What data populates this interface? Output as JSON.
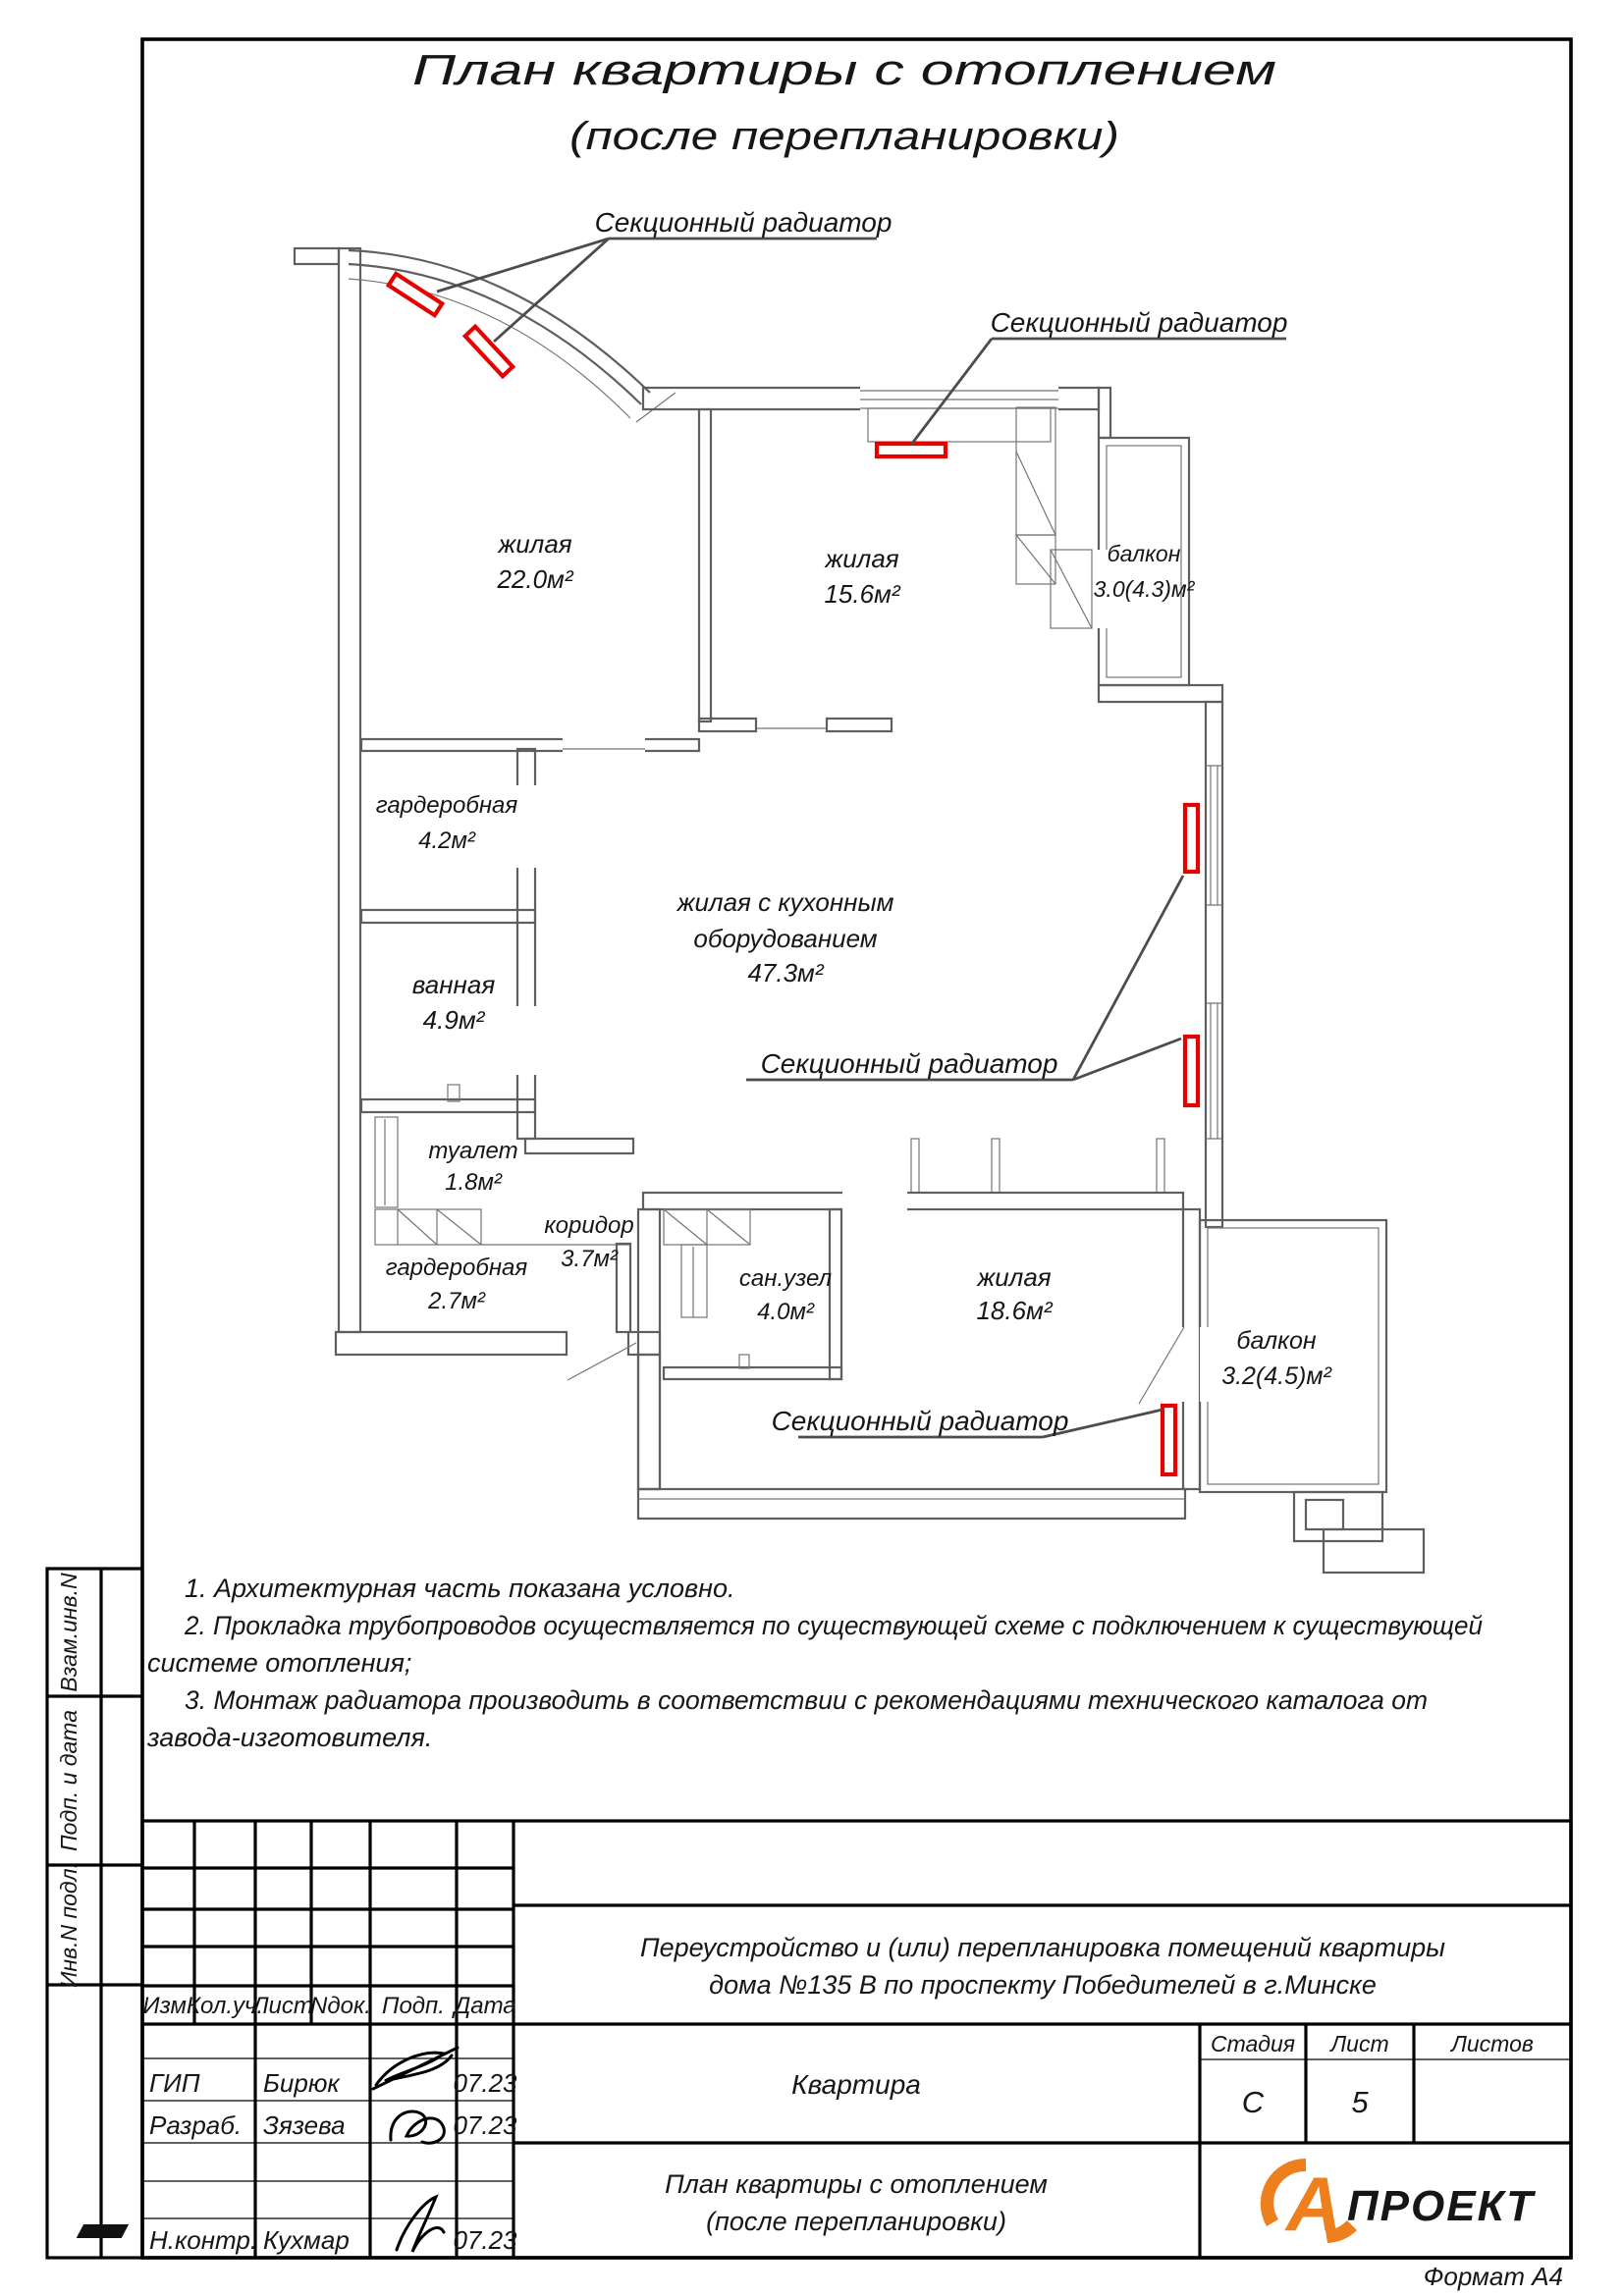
{
  "page": {
    "title_line1": "План квартиры с отоплением",
    "title_line2": "(после перепланировки)",
    "format": "Формат А4"
  },
  "colors": {
    "radiator_red": "#e60000",
    "wall_gray": "#5f5f5f",
    "logo_orange": "#ee7f1d"
  },
  "plan": {
    "radiator_label": "Секционный радиатор",
    "rooms": [
      {
        "name": "жилая",
        "area": "22.0м²"
      },
      {
        "name": "жилая",
        "area": "15.6м²"
      },
      {
        "name": "балкон",
        "area": "3.0(4.3)м²"
      },
      {
        "name": "гардеробная",
        "area": "4.2м²"
      },
      {
        "name": "ванная",
        "area": "4.9м²"
      },
      {
        "name": "туалет",
        "area": "1.8м²"
      },
      {
        "name": "коридор",
        "area": "3.7м²"
      },
      {
        "name": "гардеробная",
        "area": "2.7м²"
      },
      {
        "name": "сан.узел",
        "area": "4.0м²"
      },
      {
        "name": "жилая",
        "area": "18.6м²"
      },
      {
        "name": "балкон",
        "area": "3.2(4.5)м²"
      },
      {
        "name": "жилая с кухонным",
        "name2": "оборудованием",
        "area": "47.3м²"
      }
    ]
  },
  "notes": {
    "l1": "1. Архитектурная часть показана условно.",
    "l2": "2. Прокладка трубопроводов осуществляется по существующей схеме с подключением к существующей",
    "l3": "системе отопления;",
    "l4": "3. Монтаж радиатора производить в соответствии с рекомендациями технического каталога от",
    "l5": "завода-изготовителя."
  },
  "side_labels": {
    "vzam": "Взам.инв.N",
    "podp": "Подп. и дата",
    "inv": "Инв.N подл."
  },
  "titleblock": {
    "col_izm": "Изм.",
    "col_koluch": "Кол.уч.",
    "col_list": "Лист",
    "col_ndok": "Nдок.",
    "col_podp": "Подп.",
    "col_data": "Дата",
    "rows": [
      {
        "role": "ГИП",
        "name": "Бирюк",
        "date": "07.23"
      },
      {
        "role": "Разраб.",
        "name": "Зязева",
        "date": "07.23"
      },
      {
        "role": "Н.контр.",
        "name": "Кухмар",
        "date": "07.23"
      }
    ],
    "project_line1": "Переустройство и (или) перепланировка помещений квартиры",
    "project_line2": "дома №135 В по проспекту Победителей в г.Минске",
    "object_name": "Квартира",
    "stage_label": "Стадия",
    "sheet_label": "Лист",
    "sheets_label": "Листов",
    "stage_value": "С",
    "sheet_value": "5",
    "doc_line1": "План квартиры с отоплением",
    "doc_line2": "(после перепланировки)",
    "logo_a": "А",
    "logo_rest": "ПРОЕКТ"
  }
}
